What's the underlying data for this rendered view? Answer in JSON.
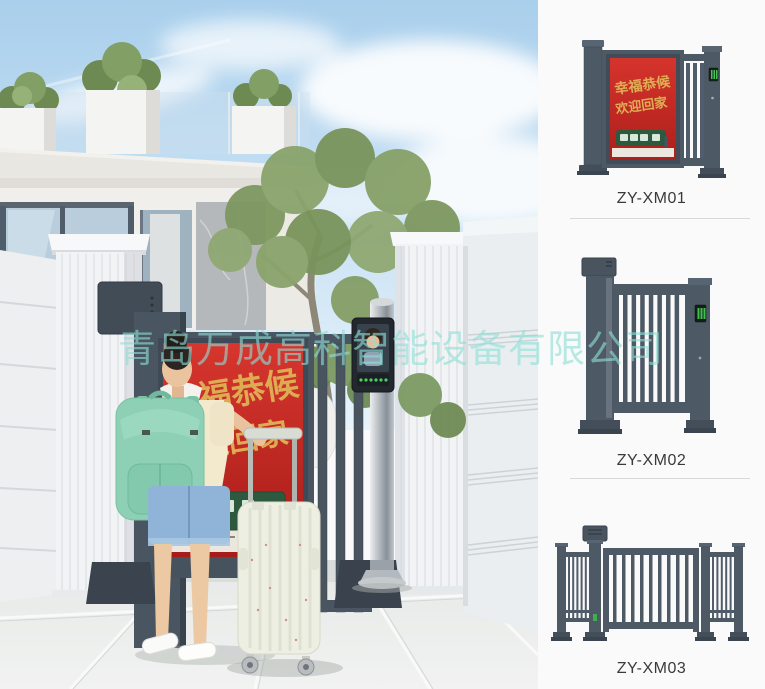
{
  "watermark": {
    "text": "青岛万成高科智能设备有限公司"
  },
  "poster": {
    "line1": "幸福恭候",
    "line2": "欢迎回家"
  },
  "products": [
    {
      "label": "ZY-XM01",
      "poster_line1": "幸福恭候",
      "poster_line2": "欢迎回家"
    },
    {
      "label": "ZY-XM02"
    },
    {
      "label": "ZY-XM03"
    }
  ],
  "colors": {
    "gate_slate": "#4a5562",
    "poster_red": "#c3251f",
    "calligraphy_gold": "#dcab52",
    "train_green": "#2d5a3f",
    "backpack_mint": "#8ed0b5",
    "access_led_green": "#3fbf4f",
    "panel_background": "#fafafa",
    "watermark_cyan": "#8eded7"
  }
}
